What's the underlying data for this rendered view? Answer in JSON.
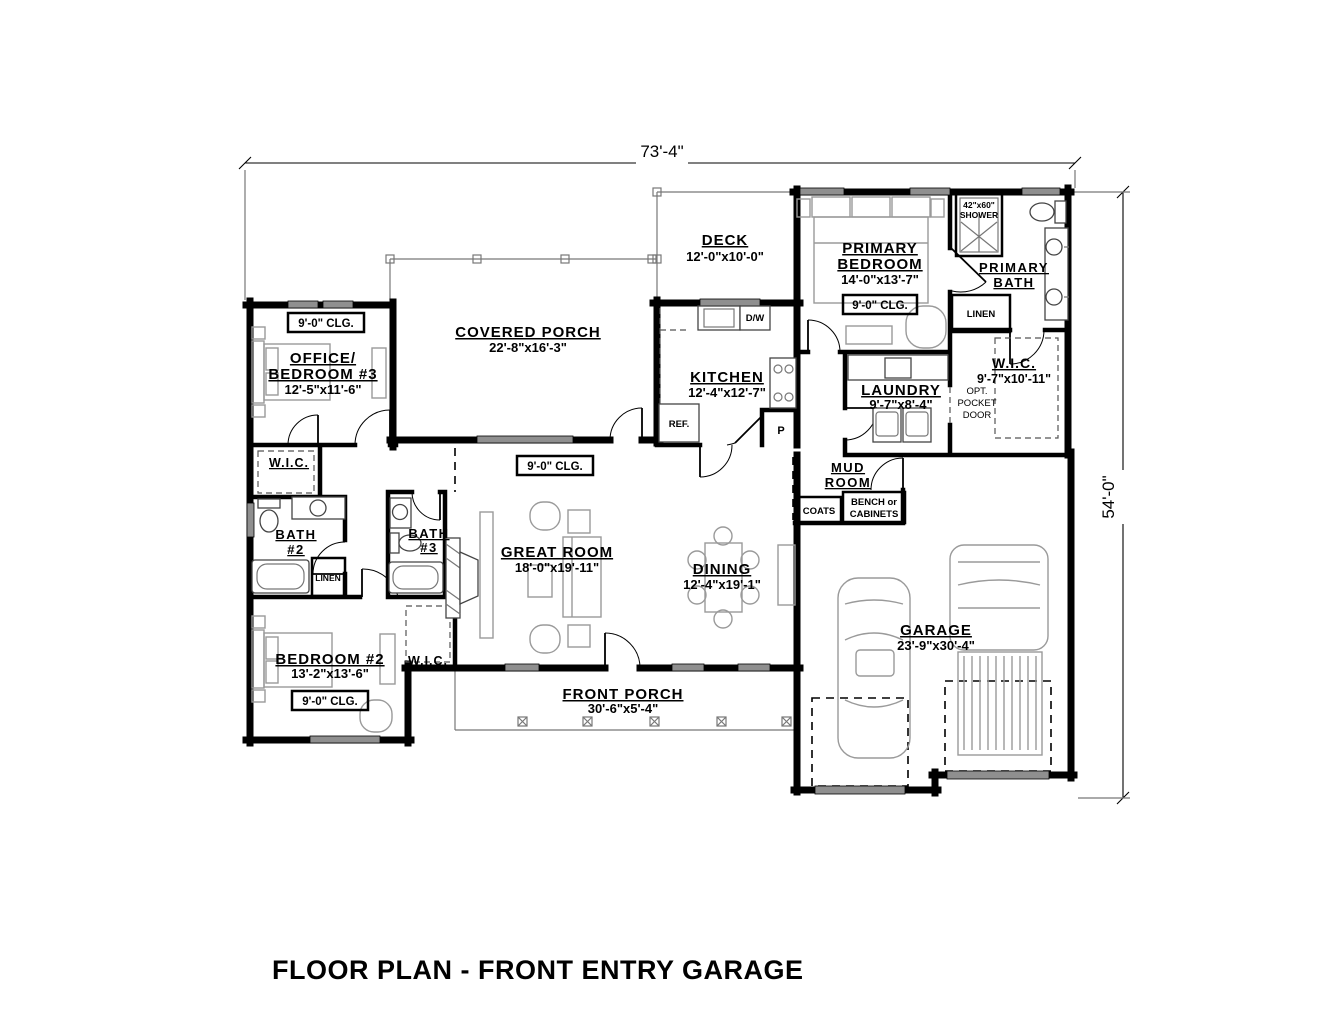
{
  "title": "FLOOR PLAN - FRONT ENTRY GARAGE",
  "dimensions": {
    "overall_width": "73'-4\"",
    "overall_height": "54'-0\""
  },
  "rooms": {
    "deck": {
      "name": "DECK",
      "size": "12'-0\"x10'-0\""
    },
    "covered_porch": {
      "name": "COVERED PORCH",
      "size": "22'-8\"x16'-3\""
    },
    "primary_bedroom": {
      "name_line1": "PRIMARY",
      "name_line2": "BEDROOM",
      "size": "14'-0\"x13'-7\"",
      "ceiling": "9'-0\" CLG."
    },
    "primary_bath": {
      "name_line1": "PRIMARY",
      "name_line2": "BATH"
    },
    "primary_wic": {
      "name": "W.I.C.",
      "size": "9'-7\"x10'-11\""
    },
    "office_bedroom3": {
      "name_line1": "OFFICE/",
      "name_line2": "BEDROOM #3",
      "size": "12'-5\"x11'-6\"",
      "ceiling": "9'-0\" CLG."
    },
    "kitchen": {
      "name": "KITCHEN",
      "size": "12'-4\"x12'-7\""
    },
    "laundry": {
      "name": "LAUNDRY",
      "size": "9'-7\"x8'-4\""
    },
    "mud_room": {
      "name_line1": "MUD",
      "name_line2": "ROOM"
    },
    "great_room": {
      "name": "GREAT ROOM",
      "size": "18'-0\"x19'-11\"",
      "ceiling": "9'-0\" CLG."
    },
    "dining": {
      "name": "DINING",
      "size": "12'-4\"x19'-1\""
    },
    "bath2": {
      "name_line1": "BATH",
      "name_line2": "#2"
    },
    "bath3": {
      "name_line1": "BATH",
      "name_line2": "#3"
    },
    "bedroom2": {
      "name": "BEDROOM #2",
      "size": "13'-2\"x13'-6\"",
      "ceiling": "9'-0\" CLG."
    },
    "bedroom2_wic": {
      "name": "W.I.C."
    },
    "office_wic": {
      "name": "W.I.C."
    },
    "garage": {
      "name": "GARAGE",
      "size": "23'-9\"x30'-4\""
    },
    "front_porch": {
      "name": "FRONT PORCH",
      "size": "30'-6\"x5'-4\""
    }
  },
  "annotations": {
    "shower_line1": "42\"x60\"",
    "shower_line2": "SHOWER",
    "linen_primary": "LINEN",
    "linen_bath2": "LINEN",
    "ref": "REF.",
    "dishwasher": "D/W",
    "pantry": "P",
    "coats": "COATS",
    "bench_line1": "BENCH or",
    "bench_line2": "CABINETS",
    "pocket_door_line1": "OPT.",
    "pocket_door_line2": "POCKET",
    "pocket_door_line3": "DOOR"
  },
  "colors": {
    "walls": "#000000",
    "furniture": "#9a9a9a",
    "windows": "#8f8f8f",
    "background": "#ffffff"
  }
}
